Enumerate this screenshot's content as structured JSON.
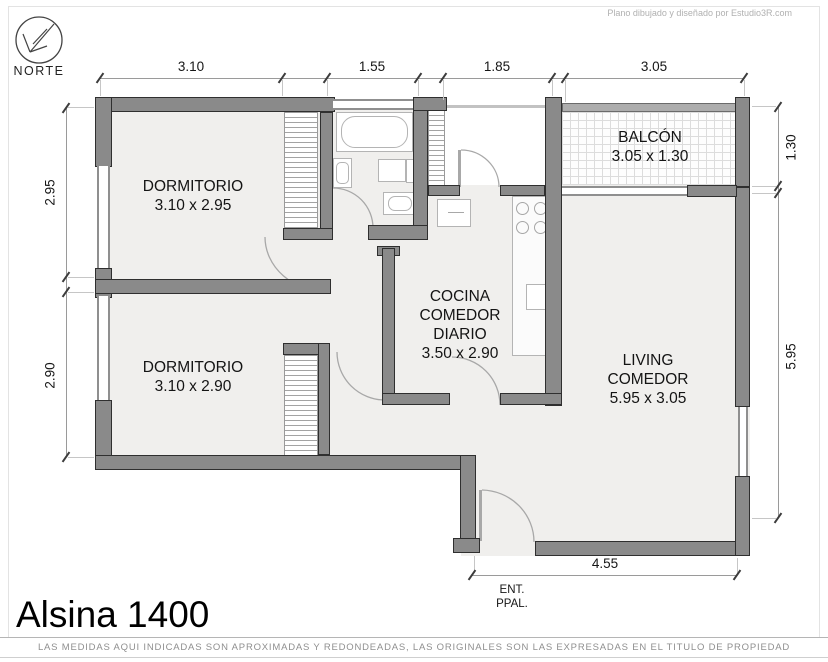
{
  "page": {
    "credit": "Plano dibujado y diseñado por Estudio3R.com",
    "title": "Alsina 1400",
    "disclaimer": "LAS MEDIDAS AQUI INDICADAS SON APROXIMADAS Y REDONDEADAS, LAS ORIGINALES SON LAS EXPRESADAS EN EL TITULO DE PROPIEDAD"
  },
  "compass": {
    "label": "NORTE"
  },
  "entrance": {
    "line1": "ENT.",
    "line2": "PPAL."
  },
  "rooms": [
    {
      "id": "dormitorio-1",
      "lines": [
        "DORMITORIO"
      ],
      "size": "3.10 x 2.95"
    },
    {
      "id": "dormitorio-2",
      "lines": [
        "DORMITORIO"
      ],
      "size": "3.10 x 2.90"
    },
    {
      "id": "cocina-comedor-diario",
      "lines": [
        "COCINA",
        "COMEDOR",
        "DIARIO"
      ],
      "size": "3.50 x 2.90"
    },
    {
      "id": "living-comedor",
      "lines": [
        "LIVING",
        "COMEDOR"
      ],
      "size": "5.95 x 3.05"
    },
    {
      "id": "balcon",
      "lines": [
        "BALCÓN"
      ],
      "size": "3.05 x 1.30"
    }
  ],
  "dimensions": {
    "top": [
      "3.10",
      "1.55",
      "1.85",
      "3.05"
    ],
    "left": [
      "2.95",
      "2.90"
    ],
    "right": [
      "1.30",
      "5.95"
    ],
    "bottom": [
      "4.55"
    ]
  },
  "colors": {
    "wall": "#8a8a8a",
    "wall_outline": "#2f2f2f",
    "floor": "#f0efed",
    "fixture_line": "#b4b4b4",
    "dim_text": "#161616"
  }
}
